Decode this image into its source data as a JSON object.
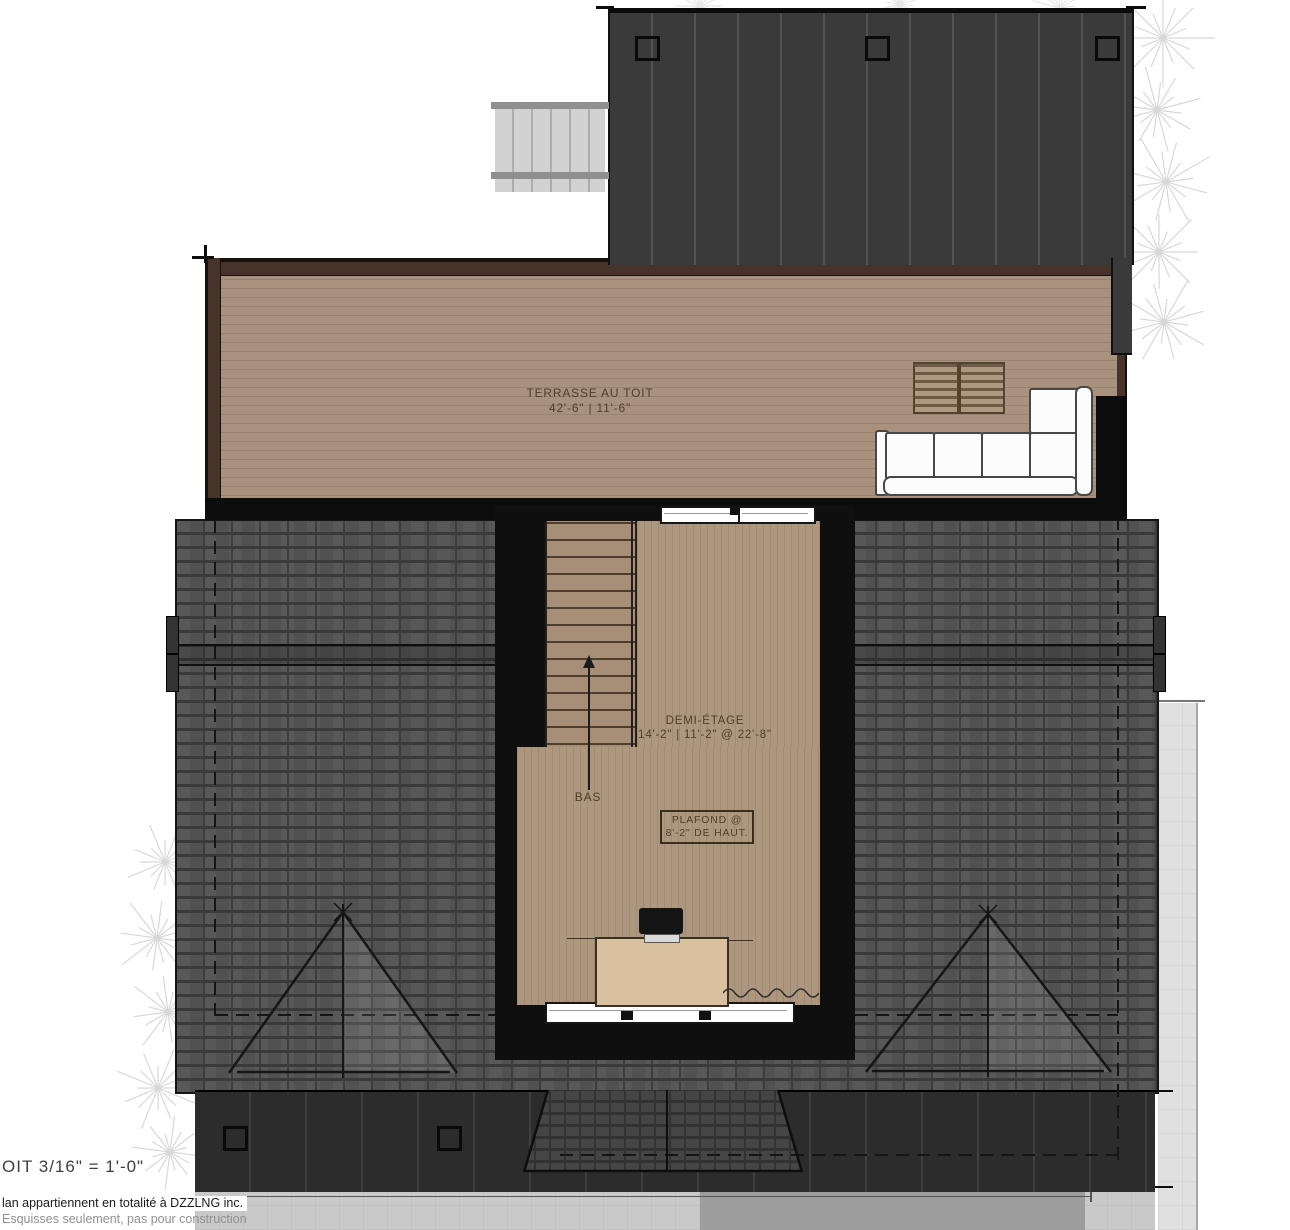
{
  "document": {
    "type": "architectural roof / half-storey plan",
    "language": "fr"
  },
  "labels": {
    "terrace": {
      "title": "TERRASSE AU TOIT",
      "dimensions": "42'-6\" | 11'-6\""
    },
    "demi_etage": {
      "title": "DEMI-ÉTAGE",
      "dimensions": "14'-2\" | 11'-2\" @ 22'-8\""
    },
    "ceiling_note": {
      "line1": "PLAFOND @",
      "line2": "8'-2\" DE HAUT."
    },
    "stairs_down": "BAS"
  },
  "titleblock": {
    "scale_text": "OIT  3/16\" = 1'-0\""
  },
  "footer": {
    "ownership": "lan appartiennent en totalité à DZZLNG inc.",
    "disclaimer": "Esquisses seulement, pas pour construction"
  },
  "colors": {
    "deck": "#a8917d",
    "roof_shingle": "#515151",
    "cladding_dark": "#3a3a3a",
    "interior_floor": "#ae977f",
    "desk": "#d9c1a0",
    "label_ink": "#503d2a"
  }
}
